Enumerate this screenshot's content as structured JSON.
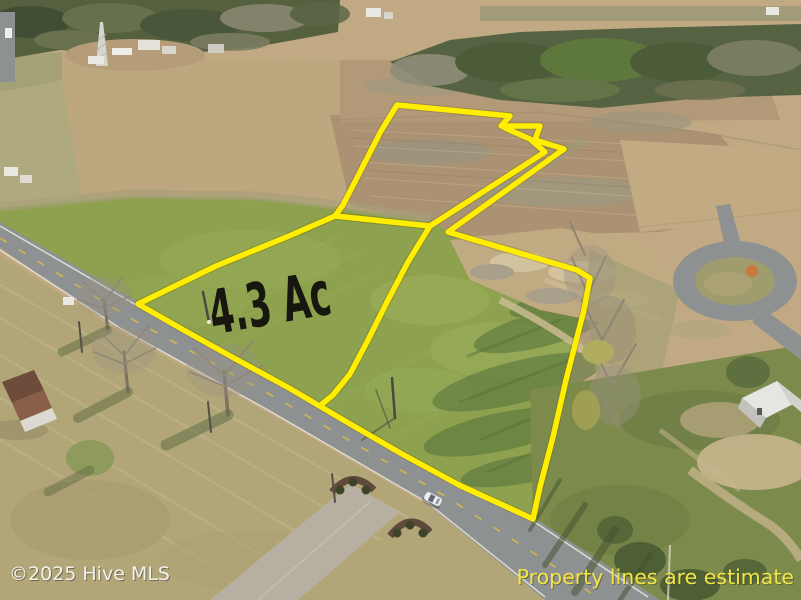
{
  "photo": {
    "description": "aerial drone photo of farmland parcels for sale",
    "boundary_color": "#ffee00",
    "annotation_ink_color": "#17170f"
  },
  "annotations": {
    "acreage_label": "4.3 Ac",
    "watermark": {
      "text": "©2025 Hive MLS",
      "color": "#f2f1ec"
    },
    "disclaimer": {
      "text": "Property lines are estimate",
      "color": "#f2e544"
    }
  }
}
